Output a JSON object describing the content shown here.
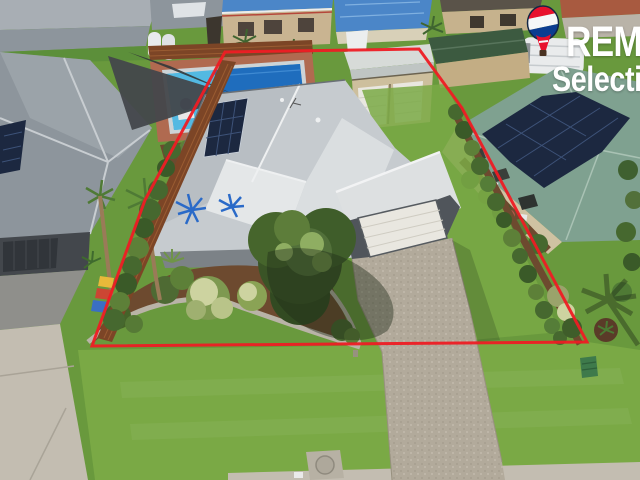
{
  "watermark": {
    "brand_text": "REM",
    "sub_text": "Selecti",
    "balloon_icon": "remax-hot-air-balloon"
  },
  "scene": {
    "type": "aerial-drone-photo",
    "subject": "single-storey house with grey metal roof outlined by red property boundary",
    "elements": [
      "red boundary outline",
      "main house grey roof",
      "rooftop solar panels",
      "blue palm roof art",
      "double garage with white door",
      "exposed aggregate driveway",
      "detached cream shed with two roller doors",
      "swimming pool with blue cover",
      "dark shade sail",
      "brown timber fences",
      "boundary hedges",
      "front garden with stone edging",
      "front lawn",
      "left neighbour grey-roof house",
      "right neighbour sage-roof house with solar array",
      "green garden shed",
      "caravan",
      "wheelie bins",
      "palm trees",
      "utility pad and green box"
    ]
  },
  "colors": {
    "boundary": "#ee1c24",
    "logo_text": "#ffffff",
    "balloon_red": "#e8112d",
    "balloon_white": "#f5f7f8",
    "balloon_blue": "#0b3d91",
    "balloon_outline": "#132744",
    "basket_brown": "#4a3222",
    "grass_base": "#69993d",
    "grass_front": "#7aa945",
    "grass_dark": "#5c8f3a",
    "roof_light": "#c6cbcf",
    "roof_bright": "#e4e7e8",
    "roof_mid": "#a8aeb4",
    "roof_dark": "#8d959c",
    "roof_sage": "#7fa190",
    "roof_sage_light": "#a9c2b4",
    "roof_blue": "#4b86c8",
    "solar": "#1c2840",
    "solar_line": "#3d5278",
    "pool": "#35a8dc",
    "tarp": "#1f6dbd",
    "fence": "#7c4526",
    "fence_light": "#9a5c32",
    "paving": "#b06a50",
    "tan_wall": "#c9b491",
    "cream_house": "#c6b28d",
    "shed_wall": "#cdbf9d",
    "door_white": "#e9e7e0",
    "wall_dark": "#43474c",
    "wall_darker": "#31353a",
    "wall_cream": "#cfc2a2",
    "drive": "#b2aa9b",
    "concrete": "#c3bdb1",
    "concrete_dark": "#8f8f8b",
    "hedge": "#46682f",
    "hedge_light": "#5d8038",
    "shrub_dark": "#3a5426",
    "shrub_mid": "#52703a",
    "shrub_light": "#8fae62",
    "flower_cream": "#cdd3a0",
    "mulch": "#6d4a2f",
    "stone": "#b9b3a7",
    "shadow": "rgba(30,42,24,0.42)",
    "art_blue": "#2a6ac8",
    "trunk": "#9a7b58",
    "red_trim": "#b5473a",
    "caravan": "#e9ebec",
    "sail": "#43474b",
    "bin_yellow": "#e8b93a",
    "bin_red": "#cc4633",
    "bin_blue": "#3a6fc4",
    "box_green": "#3e7a4b"
  }
}
